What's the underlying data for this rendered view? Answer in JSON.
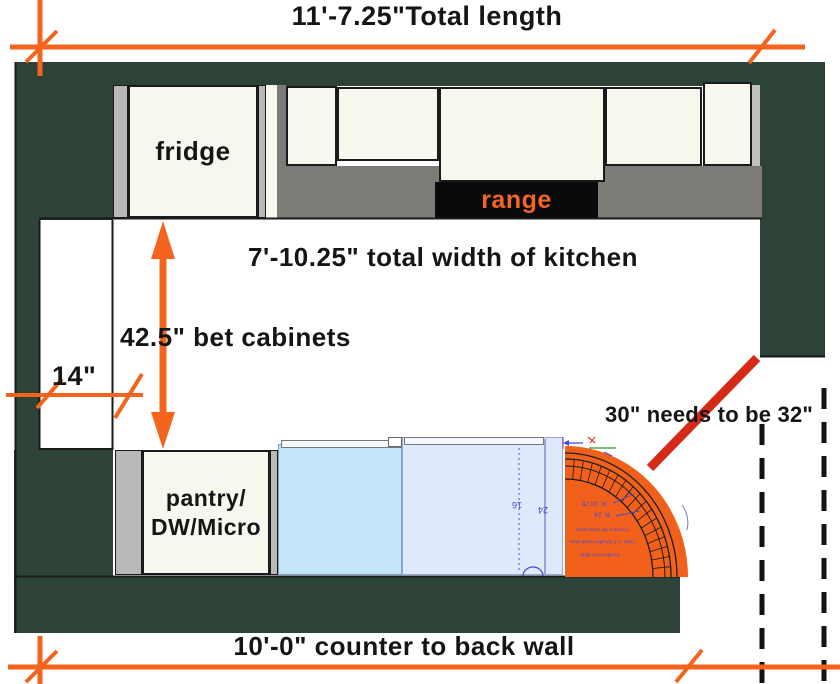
{
  "dimensions": {
    "total_length": "11'-7.25\"Total length",
    "kitchen_width": "7'-10.25\" total width of kitchen",
    "between_cabinets": "42.5\" bet cabinets",
    "left_clearance": "14\"",
    "counter_to_back_wall": "10'-0\" counter to back wall",
    "door_clearance_note": "30\" needs to be 32\""
  },
  "fixtures": {
    "fridge": "fridge",
    "range": "range",
    "pantry_line1": "pantry/",
    "pantry_line2": "DW/Micro"
  },
  "island_cad": {
    "depth": "16",
    "width": "24",
    "radius_outer": "R. 24.75",
    "radius_inner": "R. 24",
    "note_line1": "Access to full range space",
    "note_line2": "holds ~1.5 (smaller) stand mixer",
    "note_line3": "Double Doors @36"
  },
  "colors": {
    "wall_green": "#2d4337",
    "dimension_orange": "#f4641d",
    "alert_red": "#d42a17",
    "counter_gray": "#7c7b75",
    "cabinet_cream": "#f8f7ee",
    "trim_gray": "#b9b9b9",
    "island_blue_light": "#c5e4f7",
    "island_blue_pale": "#dee9fc",
    "cad_blue": "#4646d8",
    "range_black": "#0a0a0a"
  }
}
